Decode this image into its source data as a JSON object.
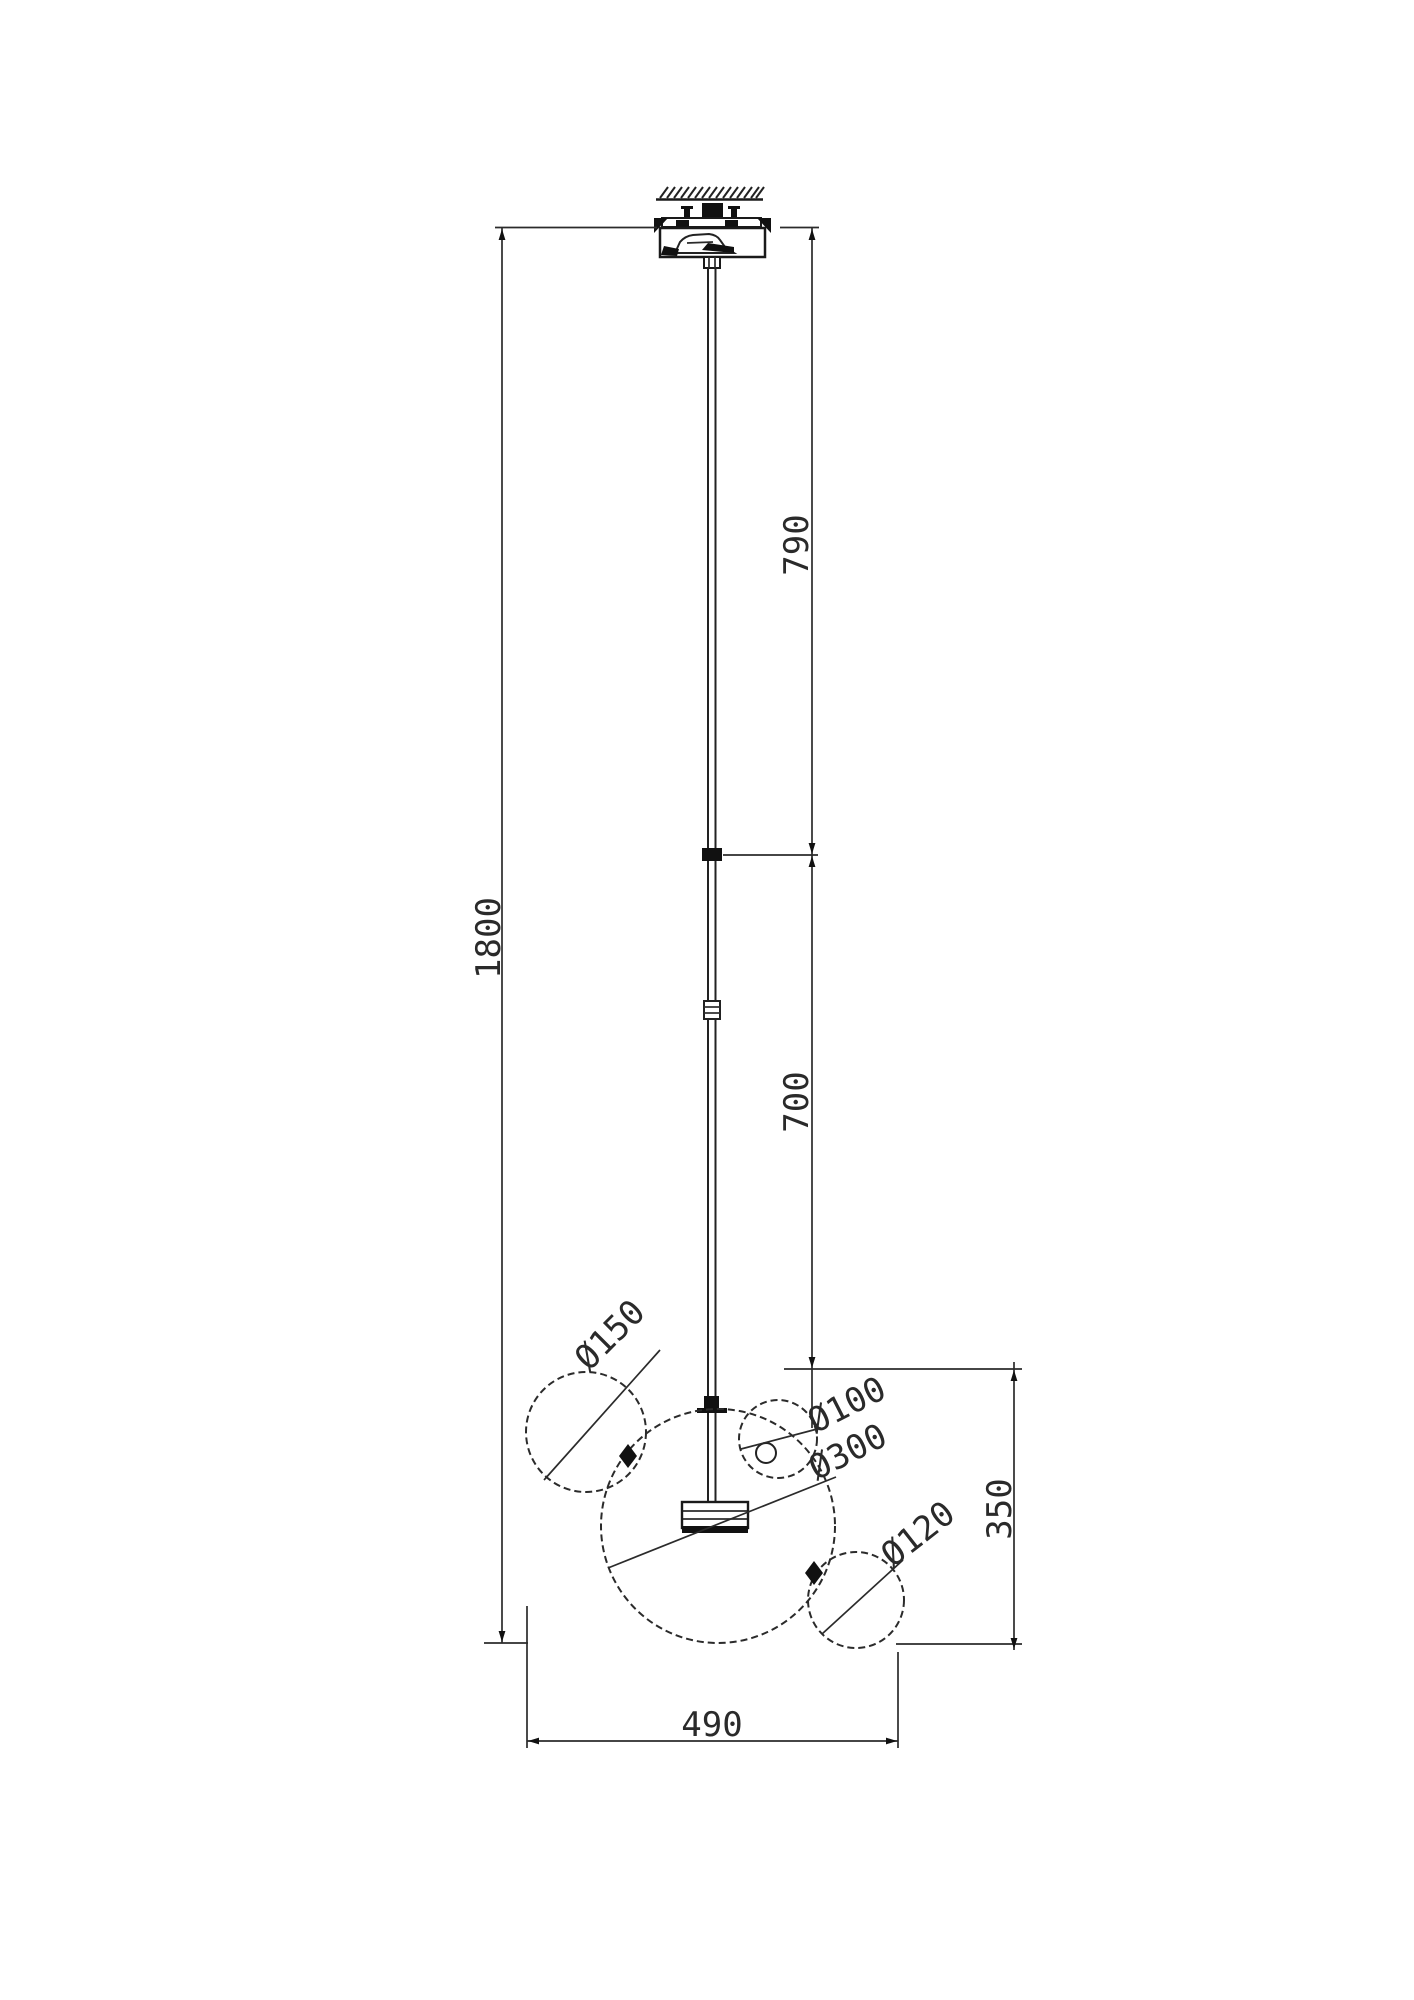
{
  "drawing": {
    "kind": "technical dimensional drawing",
    "subject": "bubble-glass pendant ceiling lamp",
    "units": "mm",
    "background_color": "#ffffff",
    "line_color": "#2b2b2b",
    "dimensions": {
      "overall_height": {
        "label": "1800",
        "value": 1800
      },
      "upper_rod": {
        "label": "790",
        "value": 790
      },
      "lower_rod": {
        "label": "700",
        "value": 700
      },
      "shade_height": {
        "label": "350",
        "value": 350
      },
      "shade_width": {
        "label": "490",
        "value": 490
      }
    },
    "diameters": {
      "bubble_150": {
        "label": "Ø150",
        "value": 150
      },
      "bubble_100": {
        "label": "Ø100",
        "value": 100
      },
      "bubble_300": {
        "label": "Ø300",
        "value": 300
      },
      "bubble_120": {
        "label": "Ø120",
        "value": 120
      }
    }
  }
}
